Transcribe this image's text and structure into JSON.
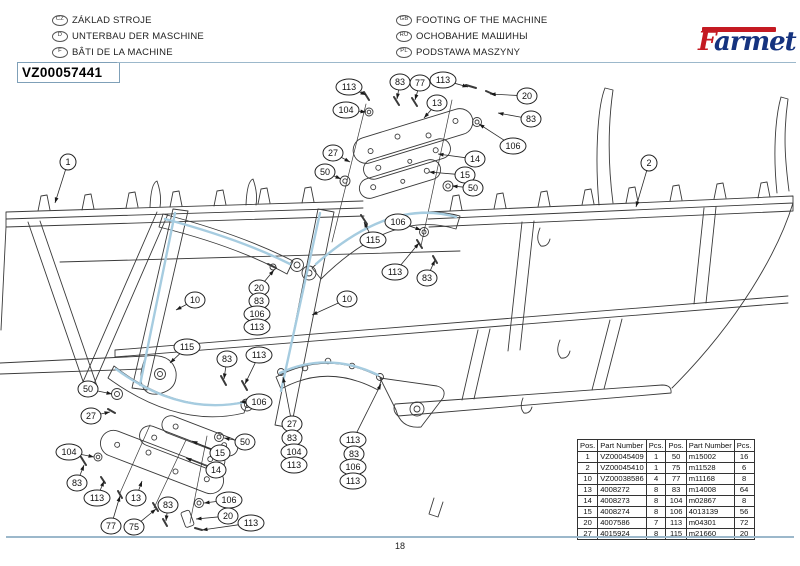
{
  "header": {
    "languages_left": [
      {
        "code": "CZ",
        "text": "ZÁKLAD STROJE"
      },
      {
        "code": "D",
        "text": "UNTERBAU DER MASCHINE"
      },
      {
        "code": "F",
        "text": "BÂTI DE LA MACHINE"
      }
    ],
    "languages_right": [
      {
        "code": "GB",
        "text": "FOOTING OF THE MACHINE"
      },
      {
        "code": "RU",
        "text": "ОСНОВАНИЕ МАШИНЫ"
      },
      {
        "code": "PL",
        "text": "PODSTAWA MASZYNY"
      }
    ],
    "part_code": "VZ00057441",
    "logo": {
      "f": "F",
      "rest": "armet"
    }
  },
  "colors": {
    "logo_red": "#c41a22",
    "logo_blue": "#15337f",
    "rule_blue": "#9cb8cb",
    "highlight_blue": "#a6cce0"
  },
  "diagram": {
    "callouts": [
      {
        "label": "1",
        "x": 68,
        "y": 162,
        "tx": 55,
        "ty": 203
      },
      {
        "label": "2",
        "x": 649,
        "y": 163,
        "tx": 636,
        "ty": 207
      },
      {
        "label": "113",
        "x": 349,
        "y": 87,
        "tx": 366,
        "ty": 95
      },
      {
        "label": "83",
        "x": 400,
        "y": 82,
        "tx": 397,
        "ty": 99
      },
      {
        "label": "77",
        "x": 420,
        "y": 83,
        "tx": 415,
        "ty": 100
      },
      {
        "label": "113",
        "x": 443,
        "y": 80,
        "tx": 468,
        "ty": 87
      },
      {
        "label": "20",
        "x": 527,
        "y": 96,
        "tx": 490,
        "ty": 94
      },
      {
        "label": "104",
        "x": 346,
        "y": 110,
        "tx": 366,
        "ty": 112
      },
      {
        "label": "13",
        "x": 437,
        "y": 103,
        "tx": 424,
        "ty": 118
      },
      {
        "label": "83",
        "x": 531,
        "y": 119,
        "tx": 498,
        "ty": 113
      },
      {
        "label": "106",
        "x": 513,
        "y": 146,
        "tx": 479,
        "ty": 124
      },
      {
        "label": "27",
        "x": 333,
        "y": 153,
        "tx": 350,
        "ty": 162
      },
      {
        "label": "14",
        "x": 475,
        "y": 159,
        "tx": 438,
        "ty": 154
      },
      {
        "label": "15",
        "x": 465,
        "y": 175,
        "tx": 429,
        "ty": 172
      },
      {
        "label": "50",
        "x": 325,
        "y": 172,
        "tx": 341,
        "ty": 179
      },
      {
        "label": "50",
        "x": 473,
        "y": 188,
        "tx": 452,
        "ty": 186
      },
      {
        "label": "115",
        "x": 373,
        "y": 240,
        "tx": 364,
        "ty": 222
      },
      {
        "label": "106",
        "x": 398,
        "y": 222,
        "tx": 421,
        "ty": 230
      },
      {
        "label": "113",
        "x": 395,
        "y": 272,
        "tx": 419,
        "ty": 243
      },
      {
        "label": "83",
        "x": 427,
        "y": 278,
        "tx": 435,
        "ty": 260
      },
      {
        "label": "10",
        "x": 195,
        "y": 300,
        "tx": 176,
        "ty": 310
      },
      {
        "label": "10",
        "x": 347,
        "y": 299,
        "tx": 312,
        "ty": 315
      },
      {
        "label": "20",
        "x": 259,
        "y": 288,
        "tx": 274,
        "ty": 270
      },
      {
        "label": "83",
        "x": 259,
        "y": 301
      },
      {
        "label": "106",
        "x": 257,
        "y": 314
      },
      {
        "label": "113",
        "x": 257,
        "y": 327
      },
      {
        "label": "115",
        "x": 187,
        "y": 347,
        "tx": 170,
        "ty": 363
      },
      {
        "label": "83",
        "x": 227,
        "y": 359,
        "tx": 224,
        "ty": 379
      },
      {
        "label": "113",
        "x": 259,
        "y": 355,
        "tx": 245,
        "ty": 384
      },
      {
        "label": "50",
        "x": 88,
        "y": 389,
        "tx": 112,
        "ty": 394
      },
      {
        "label": "106",
        "x": 259,
        "y": 402,
        "tx": 240,
        "ty": 402
      },
      {
        "label": "27",
        "x": 91,
        "y": 416,
        "tx": 110,
        "ty": 412
      },
      {
        "label": "104",
        "x": 69,
        "y": 452,
        "tx": 94,
        "ty": 457
      },
      {
        "label": "83",
        "x": 77,
        "y": 483,
        "tx": 84,
        "ty": 465
      },
      {
        "label": "113",
        "x": 97,
        "y": 498,
        "tx": 104,
        "ty": 481
      },
      {
        "label": "13",
        "x": 136,
        "y": 498,
        "tx": 142,
        "ty": 481
      },
      {
        "label": "50",
        "x": 245,
        "y": 442,
        "tx": 224,
        "ty": 438
      },
      {
        "label": "15",
        "x": 220,
        "y": 453,
        "tx": 192,
        "ty": 441
      },
      {
        "label": "14",
        "x": 216,
        "y": 470,
        "tx": 186,
        "ty": 458
      },
      {
        "label": "106",
        "x": 229,
        "y": 500,
        "tx": 204,
        "ty": 503
      },
      {
        "label": "20",
        "x": 228,
        "y": 516,
        "tx": 196,
        "ty": 519
      },
      {
        "label": "77",
        "x": 111,
        "y": 526,
        "tx": 120,
        "ty": 496
      },
      {
        "label": "75",
        "x": 134,
        "y": 527,
        "tx": 156,
        "ty": 509
      },
      {
        "label": "83",
        "x": 168,
        "y": 505,
        "tx": 166,
        "ty": 521
      },
      {
        "label": "113",
        "x": 251,
        "y": 523,
        "tx": 202,
        "ty": 530
      },
      {
        "label": "27",
        "x": 292,
        "y": 424,
        "tx": 283,
        "ty": 377
      },
      {
        "label": "83",
        "x": 292,
        "y": 438
      },
      {
        "label": "104",
        "x": 294,
        "y": 452
      },
      {
        "label": "113",
        "x": 294,
        "y": 465
      },
      {
        "label": "113",
        "x": 353,
        "y": 440,
        "tx": 381,
        "ty": 384
      },
      {
        "label": "83",
        "x": 354,
        "y": 454
      },
      {
        "label": "106",
        "x": 353,
        "y": 467
      },
      {
        "label": "113",
        "x": 353,
        "y": 481
      }
    ]
  },
  "parts_table": {
    "headers": [
      "Pos.",
      "Part Number",
      "Pcs.",
      "Pos.",
      "Part Number",
      "Pcs."
    ],
    "rows": [
      [
        "1",
        "VZ00045409",
        "1",
        "50",
        "m15002",
        "16"
      ],
      [
        "2",
        "VZ00045410",
        "1",
        "75",
        "m11528",
        "6"
      ],
      [
        "10",
        "VZ00038586",
        "4",
        "77",
        "m11168",
        "8"
      ],
      [
        "13",
        "4008272",
        "8",
        "83",
        "m14008",
        "64"
      ],
      [
        "14",
        "4008273",
        "8",
        "104",
        "m02867",
        "8"
      ],
      [
        "15",
        "4008274",
        "8",
        "106",
        "4013139",
        "56"
      ],
      [
        "20",
        "4007586",
        "7",
        "113",
        "m04301",
        "72"
      ],
      [
        "27",
        "4015924",
        "8",
        "115",
        "m21660",
        "20"
      ]
    ]
  },
  "footer": {
    "page_number": "18"
  }
}
